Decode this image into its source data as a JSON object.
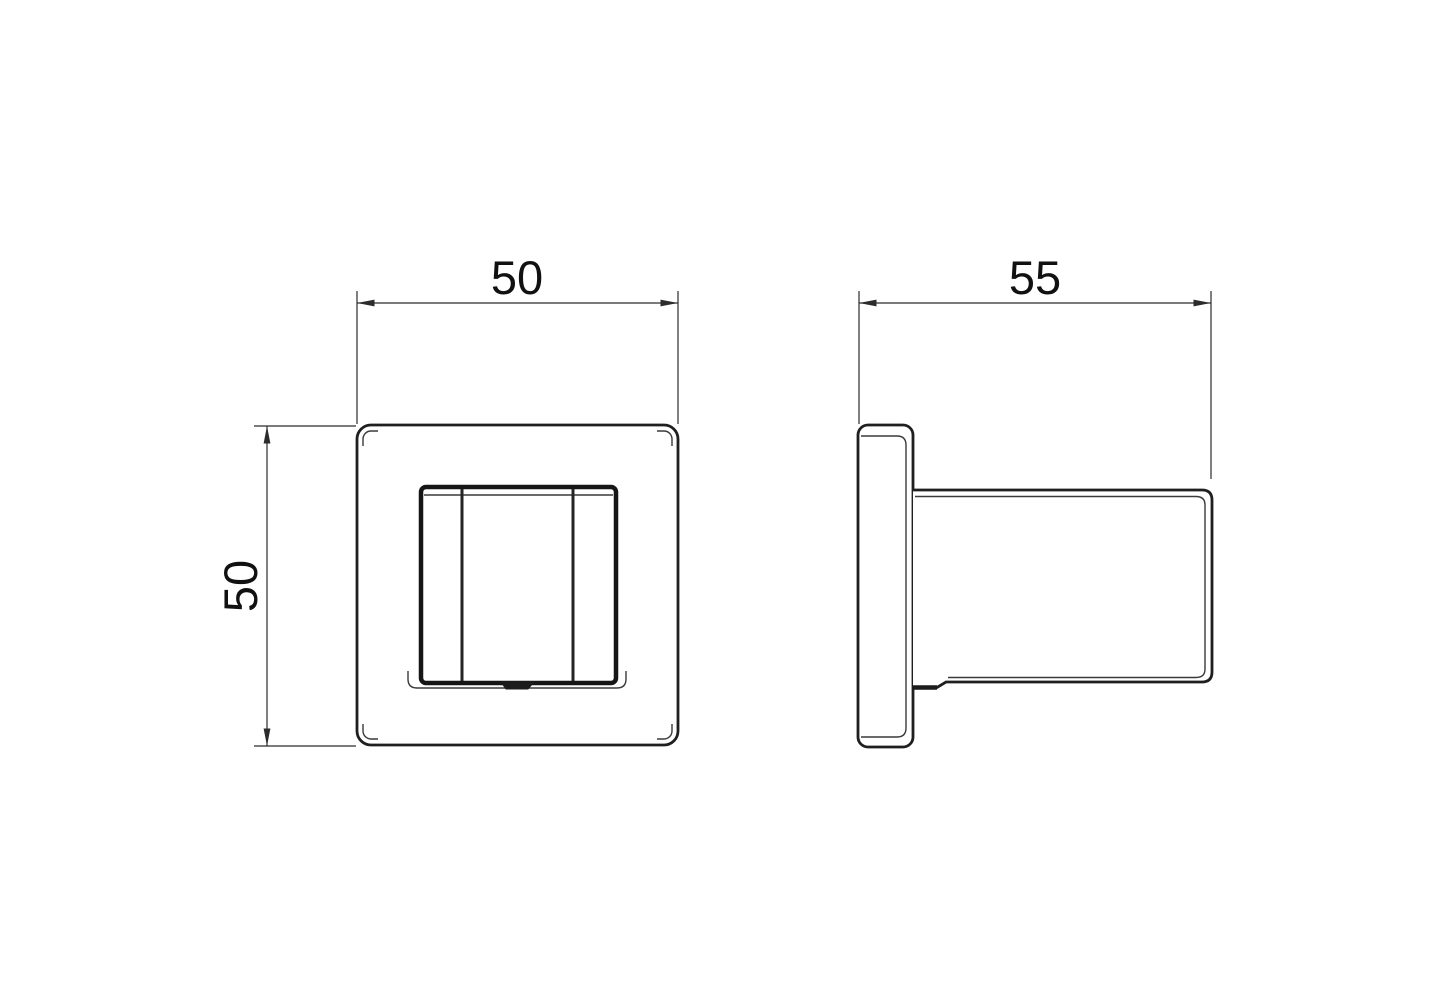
{
  "document": {
    "kind": "technical-dimension-drawing",
    "background": "#ffffff"
  },
  "colors": {
    "outline": "#1f1f1f",
    "heavy_line": "#161616",
    "thin_line": "#3a3a3a",
    "dimension_line": "#2c2c2c",
    "label_text": "#111111",
    "notch_fill": "#1c1c1c"
  },
  "dimensions": {
    "front_width": {
      "label": "50"
    },
    "front_height": {
      "label": "50"
    },
    "side_depth": {
      "label": "55"
    }
  }
}
